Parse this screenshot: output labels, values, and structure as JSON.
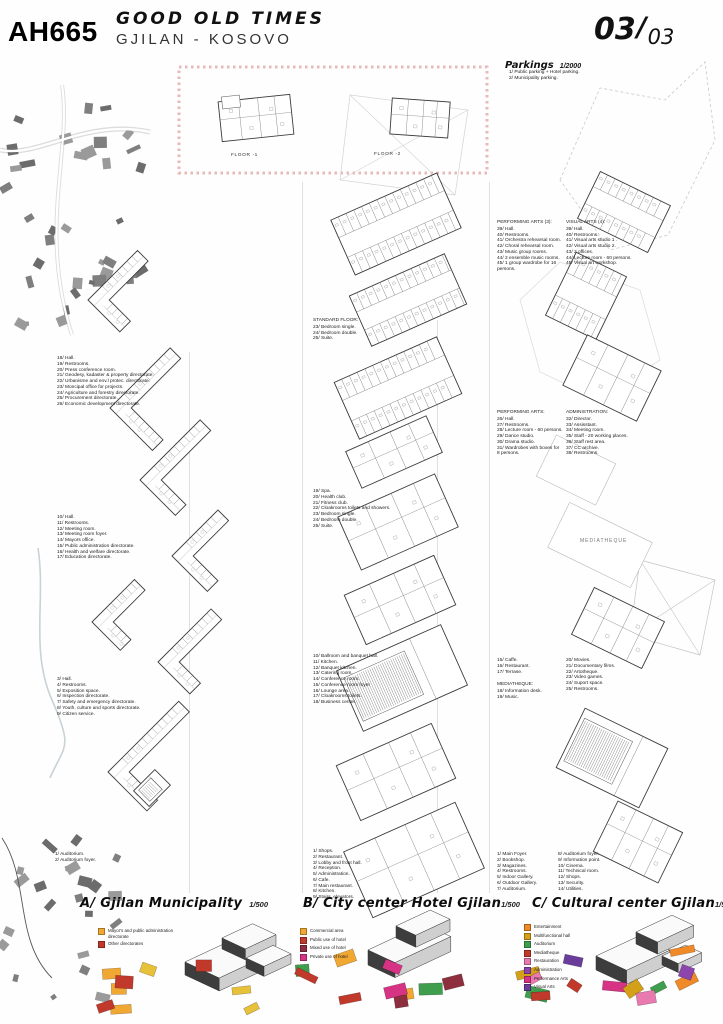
{
  "header": {
    "code": "AH665",
    "title": "GOOD OLD TIMES",
    "subtitle": "GJILAN - KOSOVO",
    "sheet_number": "03",
    "sheet_separator": "/",
    "sheet_total": "03"
  },
  "parkings": {
    "title": "Parkings",
    "scale": "1/2000",
    "list": {
      "items": [
        "1/  Public parking + Hotel parking.",
        "2/  Municipality parking."
      ]
    }
  },
  "inset": {
    "floor_labels": [
      "FLOOR -1",
      "FLOOR -2"
    ]
  },
  "plan_labels": {
    "mediatheque": "MEDIATHEQUE"
  },
  "columns": {
    "municipality": {
      "blocks": [
        {
          "items": [
            "18/ Hall.",
            "19/ Restrooms.",
            "20/ Press conference room.",
            "21/ Geodesy, kadaster & property directorate.",
            "22/ Urbanisme and env.l protec. directorate.",
            "23/ Moncipal office for projects.",
            "24/ Agriculture and forestry directorate.",
            "25/ Procurement directorate.",
            "26/ Economic development directorate."
          ]
        },
        {
          "items": [
            "10/ Hall.",
            "11/ Restrooms.",
            "12/ Meeting room.",
            "13/ Meeting room foyer.",
            "14/ Mayors office.",
            "15/ Public administration directorate.",
            "16/ Health and welfare directorate.",
            "17/ Education directorate."
          ]
        },
        {
          "items": [
            "3/ Hall.",
            "4/ Restrooms.",
            "5/ Exposition space.",
            "6/ Inspection directorate.",
            "7/ Safety and emergency directorate.",
            "8/ Youth, culture and sports directorate.",
            "9/ Citizen service."
          ]
        },
        {
          "items": [
            "1/  Auditorium.",
            "2/  Auditorium foyer."
          ]
        }
      ]
    },
    "hotel": {
      "blocks": [
        {
          "title": "STANDARD FLOOR:",
          "items": [
            "23/ Bedroom single.",
            "24/ Bedroom double.",
            "25/ Suite."
          ]
        },
        {
          "items": [
            "19/ Spa.",
            "20/ Health club.",
            "21/ Fitness club.",
            "22/ Cloakrooms toilets and showers.",
            "23/ Bedroom single.",
            "24/ Bedroom double.",
            "25/ Suite."
          ]
        },
        {
          "items": [
            "10/ Ballroom and banquet hall.",
            "11/ Kitchen.",
            "12/ Banquet kitchen.",
            "13/ Catering room.",
            "14/ Conference room.",
            "15/ Conference room foyer",
            "16/ Lounge area.",
            "17/ Cloakrooms toilets.",
            "18/ Business center."
          ]
        },
        {
          "items": [
            "1/  Shops.",
            "2/  Restaurant.",
            "3/  Lobby and front hall.",
            "4/  Reception.",
            "5/  Administration.",
            "6/  Cafe.",
            "7/  Main restaurant.",
            "8/  Kitchen.",
            "9/  Stairs, elevators."
          ]
        }
      ]
    },
    "cultural": {
      "blocks": [
        {
          "title": "PERFORMING ARTS (3):",
          "items": [
            "39/ Hall.",
            "40/ Restrooms.",
            "41/ Orchestra rehearsal room.",
            "42/ Choral rehearsal room.",
            "43/ Music group rooms.",
            "44/ 2 ensemble music rooms.",
            "45/ 1 group wardrobe for 16 persons."
          ]
        },
        {
          "title": "VISUAL ARTS (4):",
          "items": [
            "39/ Hall.",
            "40/ Restrooms.",
            "41/ Visual arts studio 1 .",
            "42/ Visual arts studio 2.",
            "43/ 2 offices.",
            "44/ Lecture room - 60 persons.",
            "45/ Visual art workshop."
          ]
        },
        {
          "title": "PERFORMING ARTS:",
          "items": [
            "26/ Hall.",
            "27/ Restrooms.",
            "28/ Lecture room - 60 persons.",
            "29/ Dance studio.",
            "30/ Drama studio.",
            "31/ Wardrobes with boxes for 8 persons."
          ]
        },
        {
          "title": "ADMINISTRATION:",
          "items": [
            "32/ Director.",
            "33/ Assisstant.",
            "34/ Meeting room.",
            "35/ Staff - 20 working places.",
            "36/ Staff rest area.",
            "37/ CC archive.",
            "38/ Restrooms."
          ]
        },
        {
          "items": [
            "15/ Caffe.",
            "16/ Restaurant.",
            "17/ Terrase."
          ]
        },
        {
          "title": "MEDIATHEQUE:",
          "items": [
            "18/ Information desk.",
            "19/ Music."
          ]
        },
        {
          "items": [
            "20/ Movies.",
            "21/ Documentary films.",
            "22/ Artotheque.",
            "23/ Video games.",
            "24/ Suport space.",
            "25/ Restrooms."
          ]
        },
        {
          "items": [
            "1/  Main Foyer.",
            "2/  Bookshop.",
            "3/  Magazines.",
            "4/  Restrooms.",
            "5/  Indoor Gallery.",
            "6/  Outdoor Gallery.",
            "7/  Auditorium."
          ]
        },
        {
          "items": [
            "8/  Auditorium foyer.",
            "9/  Information point.",
            "10/ Cinema.",
            "11/ Technical room.",
            "12/ Shops.",
            "13/ Security.",
            "14/ Utilities."
          ]
        }
      ]
    }
  },
  "footer": {
    "sections": [
      {
        "title": "A/ Gjilan Municipality",
        "scale": "1/500",
        "legend": [
          {
            "color": "#f0a832",
            "label": "Mayor's and public administration directorate"
          },
          {
            "color": "#c0392b",
            "label": "Other directorates"
          }
        ]
      },
      {
        "title": "B/ City center Hotel Gjilan",
        "scale": "1/500",
        "legend": [
          {
            "color": "#f0a832",
            "label": "Commercial area"
          },
          {
            "color": "#c0392b",
            "label": "Public use of hotel"
          },
          {
            "color": "#8e2f3f",
            "label": "Mixed use of hotel"
          },
          {
            "color": "#d63384",
            "label": "Private use of hotel"
          }
        ]
      },
      {
        "title": "C/ Cultural center Gjilan",
        "scale": "1/500",
        "legend": [
          {
            "color": "#f08a28",
            "label": "Entertainment"
          },
          {
            "color": "#d4a017",
            "label": "Multifunctional hall"
          },
          {
            "color": "#3f9e4d",
            "label": "Auditorium"
          },
          {
            "color": "#c0392b",
            "label": "Mediatheque"
          },
          {
            "color": "#e87ab0",
            "label": "Restauration"
          },
          {
            "color": "#8e44ad",
            "label": "Administration"
          },
          {
            "color": "#d63384",
            "label": "Performance Arts"
          },
          {
            "color": "#6a3d9a",
            "label": "Visual Arts"
          }
        ]
      }
    ]
  }
}
